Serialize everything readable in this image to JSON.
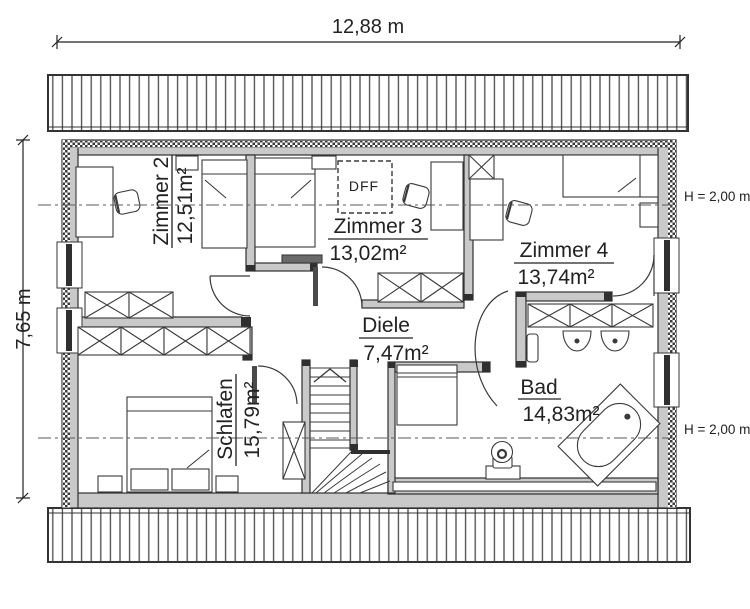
{
  "plan": {
    "width_dimension": "12,88 m",
    "height_dimension": "7,65 m",
    "roof_window_label": "DFF",
    "knee_wall_height_upper": "H = 2,00 m",
    "knee_wall_height_lower": "H = 2,00 m",
    "rooms": [
      {
        "name": "Zimmer 2",
        "area": "12,51m²"
      },
      {
        "name": "Zimmer 3",
        "area": "13,02m²"
      },
      {
        "name": "Zimmer 4",
        "area": "13,74m²"
      },
      {
        "name": "Diele",
        "area": "7,47m²"
      },
      {
        "name": "Schlafen",
        "area": "15,79m²"
      },
      {
        "name": "Bad",
        "area": "14,83m²"
      }
    ],
    "colors": {
      "wall_fill": "#c9c9c9",
      "outline": "#2f2f2f",
      "background": "#ffffff"
    }
  }
}
